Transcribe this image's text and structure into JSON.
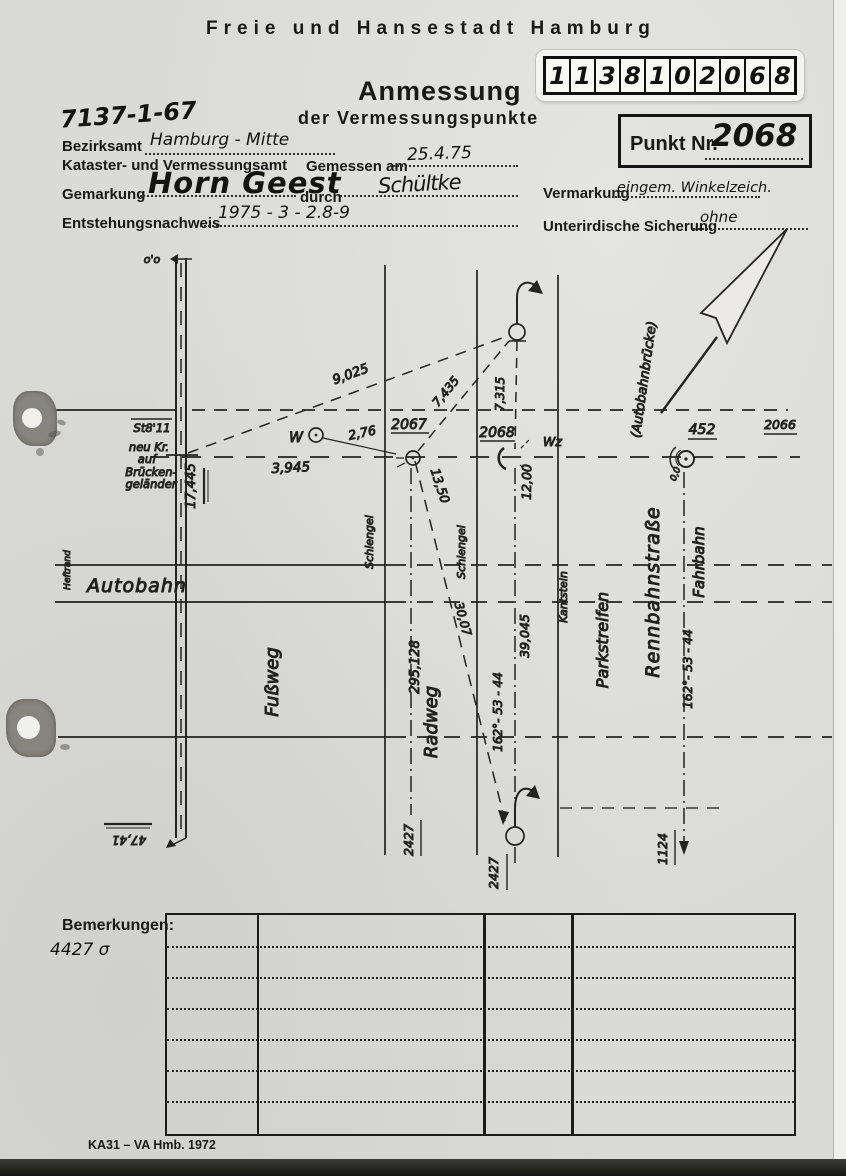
{
  "page": {
    "header": "Freie und Hansestadt Hamburg",
    "doc_number": "7137-1-67",
    "title": "Anmessung",
    "subtitle": "der Vermessungspunkte",
    "sticker_digits": [
      "1",
      "1",
      "3",
      "8",
      "1",
      "0",
      "2",
      "0",
      "6",
      "8"
    ],
    "punkt_label": "Punkt Nr.",
    "punkt_value": "2068",
    "footer": "KA31 – VA Hmb. 1972"
  },
  "form": {
    "bezirksamt_label": "Bezirksamt",
    "bezirksamt_value": "Hamburg - Mitte",
    "amt_label": "Kataster- und Vermessungsamt",
    "gemessen_label": "Gemessen am",
    "gemessen_value": "25.4.75",
    "gemarkung_label": "Gemarkung",
    "gemarkung_value": "Horn Geest",
    "durch_label": "durch",
    "durch_value": "Schültke",
    "entstehung_label": "Entstehungsnachweis",
    "entstehung_value": "1975 - 3 - 2.8-9",
    "vermarkung_label": "Vermarkung",
    "vermarkung_value": "eingem. Winkelzeich.",
    "sicherung_label": "Unterirdische Sicherung",
    "sicherung_value": "ohne"
  },
  "sketch": {
    "rail_top": "o'o",
    "rail_bottom": "47,41",
    "station": "St8'11",
    "note_line1": "neu Kr.",
    "note_line2": "auf",
    "note_line3": "Brücken-",
    "note_line4": "geländer",
    "m17445": "17,445",
    "m9025": "9,025",
    "m3945": "3,945",
    "m276": "2,76",
    "w_label": "W",
    "p2067": "2067",
    "m7435": "7,435",
    "m7315": "7,315",
    "p2068": "2068",
    "wz_label": "Wz",
    "m1350": "13,50",
    "m1200": "12,00",
    "m3007": "30,07",
    "m39045": "39,045",
    "m295128": "295,128",
    "angle1": "162°- 53 - 44",
    "angle2": "162°- 53 - 44",
    "p452": "452",
    "p2066": "2066",
    "m00": "0,0",
    "p2427a": "2427",
    "p2427b": "2427",
    "p1124": "1124",
    "heftrand": "Heftrand",
    "road_autobahn": "Autobahn",
    "road_fussweg": "Fußweg",
    "road_radweg": "Radweg",
    "schlengel1": "Schlengel",
    "schlengel2": "Schlengel",
    "kantstein": "Kantstein",
    "parkstreifen": "Parkstreifen",
    "rennbahnstrasse": "Rennbahnstraße",
    "fahrbahn": "Fahrbahn",
    "autobahnbruecke": "(Autobahnbrücke)"
  },
  "bemerkungen": {
    "label": "Bemerkungen:",
    "note": "4427 σ"
  }
}
